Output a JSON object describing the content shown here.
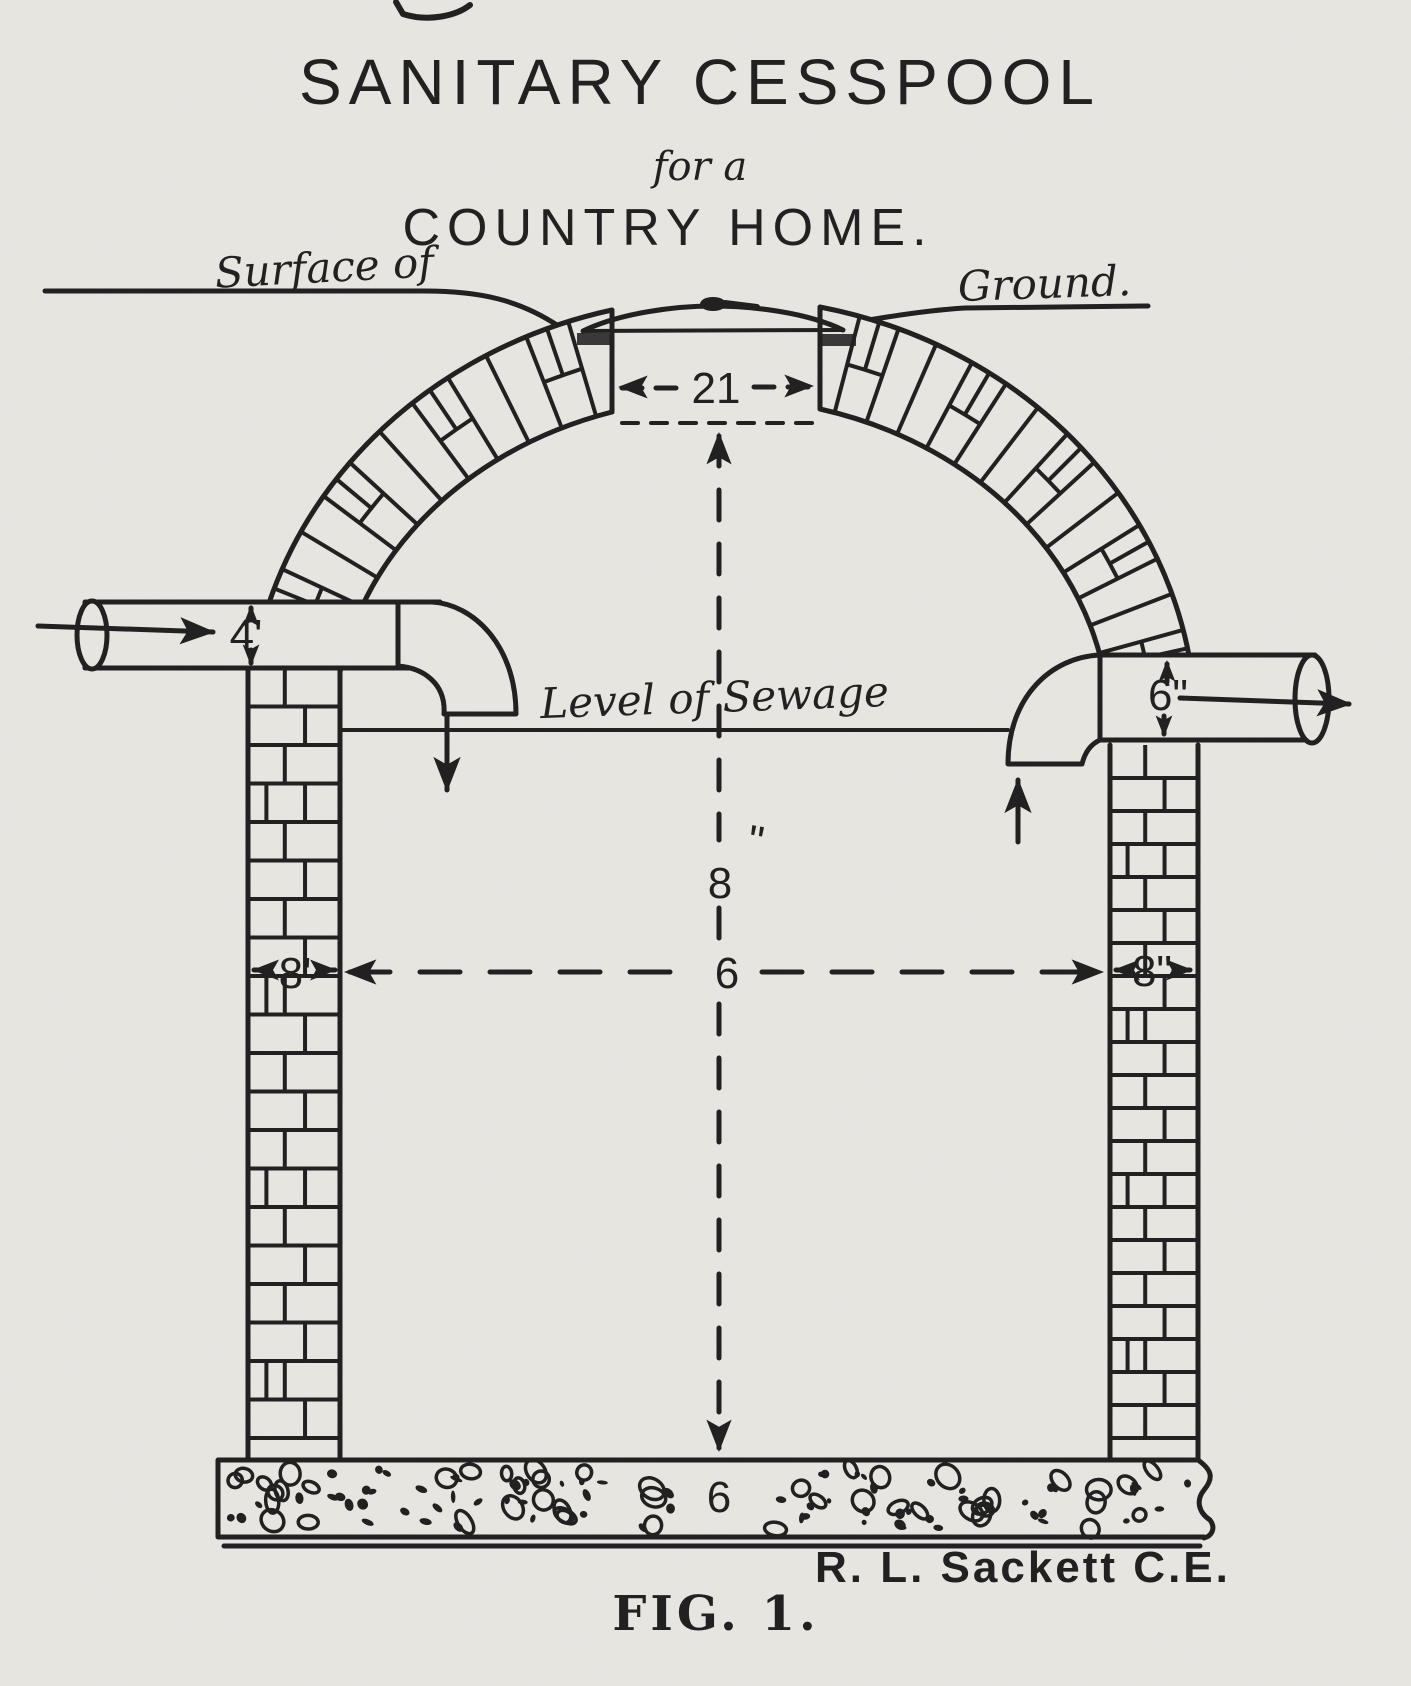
{
  "figure": {
    "title": {
      "line1": "SANITARY CESSPOOL",
      "line2": "for a",
      "line3": "COUNTRY HOME."
    },
    "annotations": {
      "surface_of": "Surface of",
      "ground": "Ground.",
      "level_of_sewage": "Level of Sewage"
    },
    "dimensions": {
      "top_opening": "21",
      "inlet_pipe_diameter": "4'",
      "outlet_pipe_diameter": "6\"",
      "chamber_depth": "8",
      "chamber_depth_unit": "\"",
      "chamber_width": "6",
      "left_wall_thickness": "8'",
      "right_wall_thickness": "8\"",
      "floor_thickness": "6"
    },
    "signature": "R. L. Sackett C.E.",
    "caption": "FIG. 1."
  },
  "colors": {
    "paper": "#e9e7e2",
    "ink": "#1c1c1c"
  }
}
